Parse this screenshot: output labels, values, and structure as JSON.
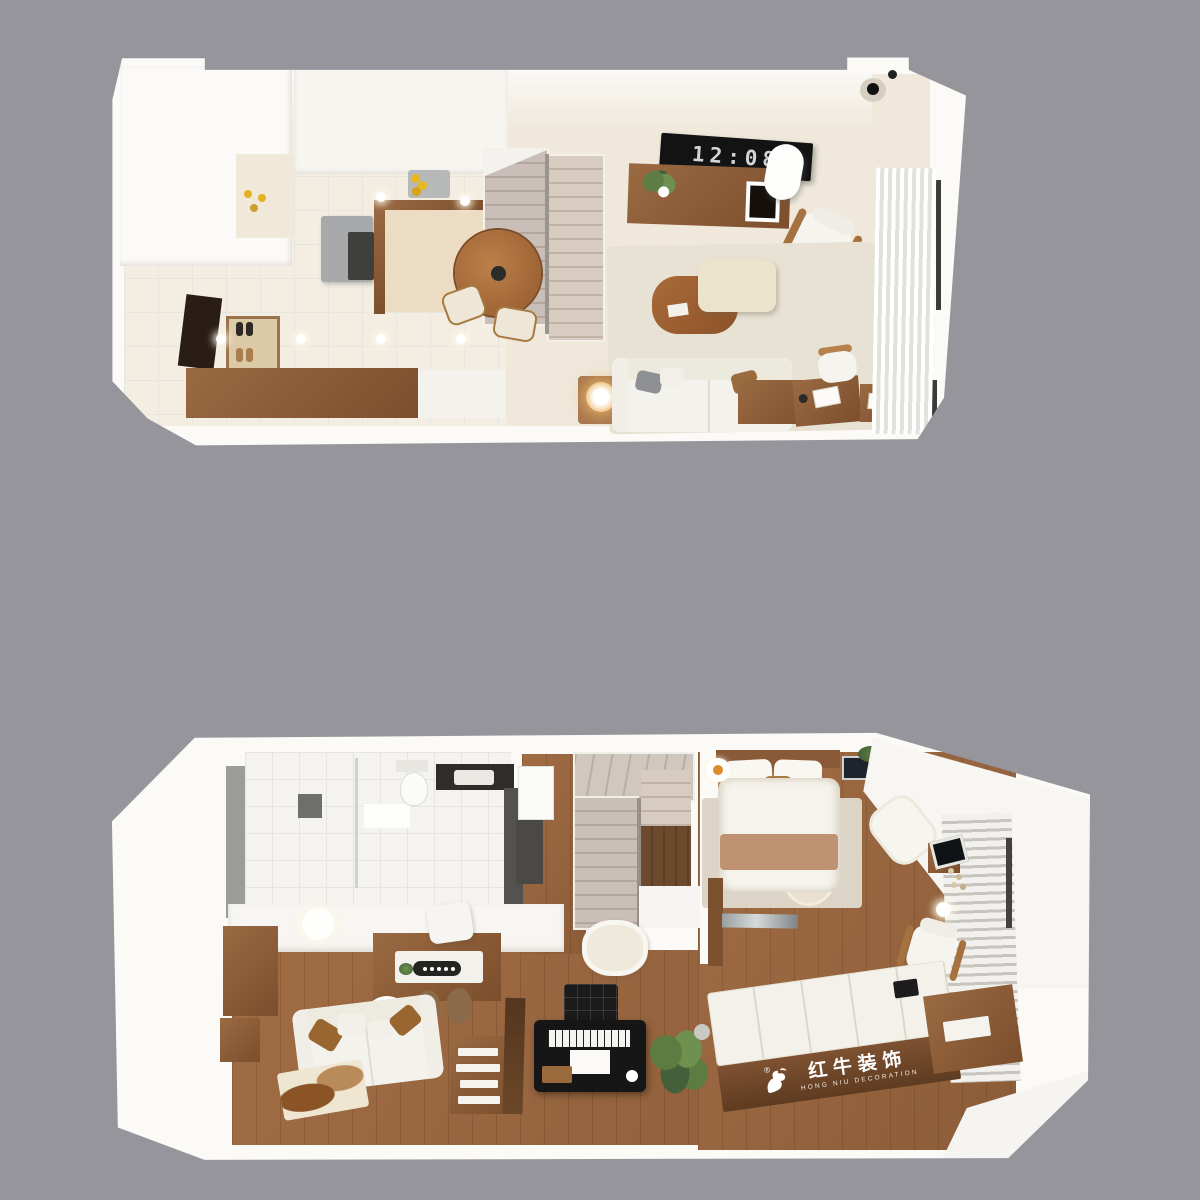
{
  "colors": {
    "background": "#96959c",
    "walls": "#fbfaf7",
    "tile_floor": "#f3ede2",
    "warm_floor": "#efe8db",
    "wood_floor": "#96653f",
    "walnut_furniture": "#8a5a38",
    "living_rug": "#e8e2d4",
    "piano_black": "#161616",
    "clock_panel": "#131313",
    "clock_digits": "#d3d4d6",
    "watermark_text": "#ffffff"
  },
  "upper_floor": {
    "tv_clock_time": "12:08"
  },
  "lower_floor": {
    "watermark": {
      "registered_mark": "®",
      "brand_cn": "红牛装饰",
      "brand_en": "HONG NIU DECORATION"
    }
  }
}
